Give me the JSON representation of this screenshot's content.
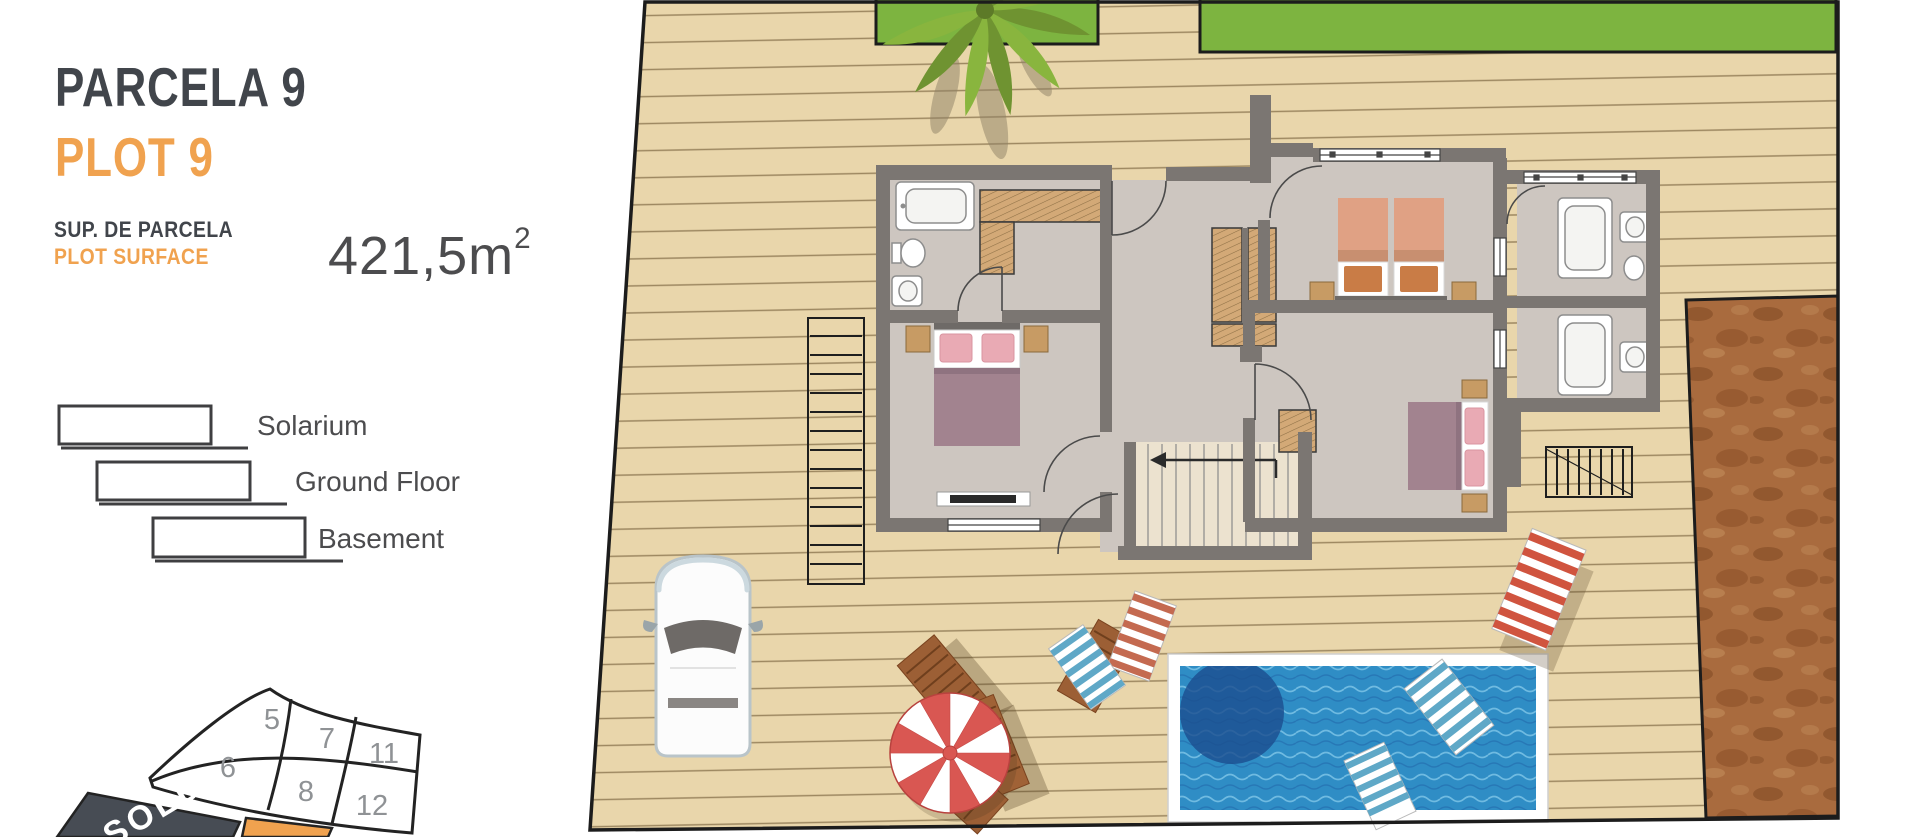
{
  "panel": {
    "title_primary": "PARCELA 9",
    "title_secondary": "PLOT 9",
    "surface_label_primary": "SUP. DE PARCELA",
    "surface_label_secondary": "PLOT SURFACE",
    "surface_value": "421,5m",
    "surface_superscript": "2",
    "legend": [
      {
        "label": "Solarium"
      },
      {
        "label": "Ground Floor"
      },
      {
        "label": "Basement"
      }
    ]
  },
  "site_map": {
    "plot_numbers": [
      "5",
      "7",
      "11",
      "6",
      "8",
      "12"
    ],
    "sold_label": "SOLD",
    "sold_fill": "#474c54",
    "highlight_fill": "#f0a24f",
    "number_color": "#8f9295"
  },
  "plan": {
    "features": [
      "wood-deck",
      "lawn-strips",
      "palm-tree",
      "ground-floor-plan",
      "basement-stairs",
      "swimming-pool",
      "car",
      "parasol",
      "sun-loungers",
      "dirt-patch"
    ],
    "colors": {
      "deck": "#e9d6ab",
      "plank_line": "#8a744e",
      "boundary": "#1c1c1c",
      "grass": "#7db440",
      "dirt": "#a96b3e",
      "wall": "#7b7672",
      "floor": "#cdc6c0",
      "stair_floor": "#ece2cf",
      "wardrobe": "#d3a977",
      "pool_water": "#2f8dc5",
      "pool_deep": "#1c4e8f",
      "pool_frame": "#ffffff",
      "parasol_red": "#d95752",
      "lounger_wood": "#9c5f35",
      "towel_blue": "#5fa8c7",
      "towel_red": "#d0543f",
      "accent_orange": "#f0a24f",
      "title_dark": "#41454b"
    }
  }
}
